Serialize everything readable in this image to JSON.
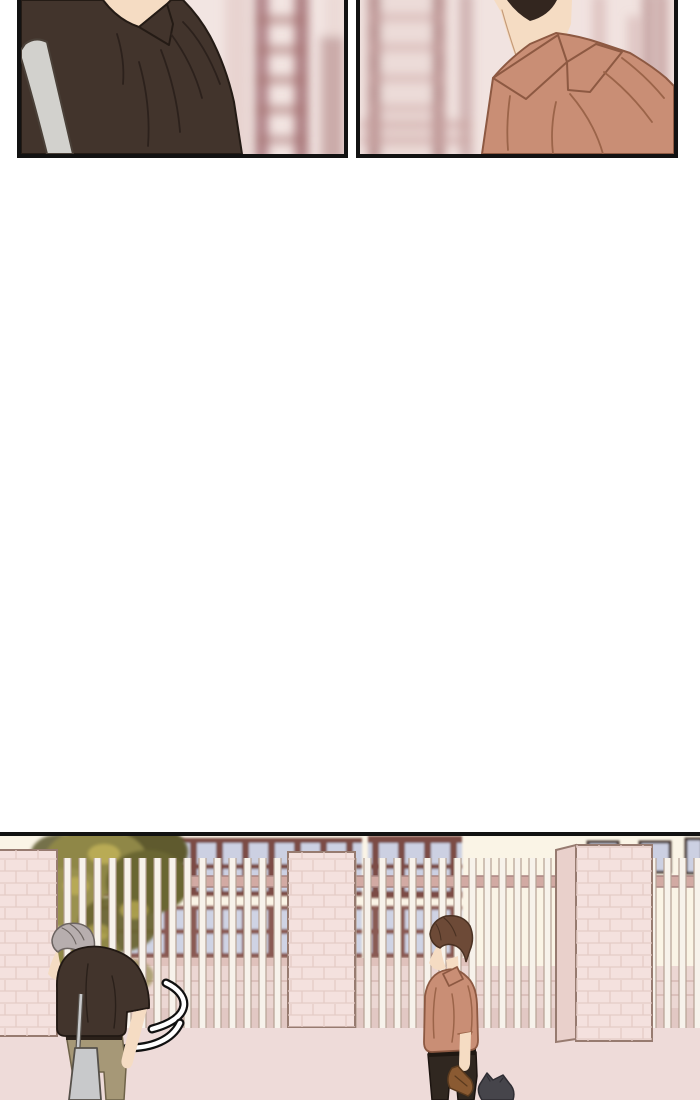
{
  "page": {
    "kind": "webtoon-comic-episode-page",
    "text_content": "none (wordless comic panels)"
  },
  "palette": {
    "page_bg": "#ffffff",
    "panel_border": "#121212",
    "skin": "#f5dcc3",
    "skin_line": "#c59a78",
    "p1_bg": "#f2e5e2",
    "p1_blur_dark": "#9c646a",
    "p1_blur_mid": "#a4706f",
    "p1_blur_light": "#e7d2ce",
    "p1_shirt": "#42342c",
    "p1_shirt_line": "#241b15",
    "p1_fold": "#2c211c",
    "p1_strap": "#d2d1cd",
    "p1_strap_line": "#4a4038",
    "p2_bg": "#f1e3e0",
    "p2_blur_dark": "#a26f70",
    "p2_blur_light": "#ead7d4",
    "p2_blur_band": "#c9a2a0",
    "p2_shirt": "#c98e75",
    "p2_shirt_line": "#8d5942",
    "p2_fold": "#9b6449",
    "p2_hair": "#33261f",
    "p3_building": "#faf4e6",
    "p3_ground": "#eedbd9",
    "p3_ground_line": "#c9a9a5",
    "p3_window_frame": "#7b4b45",
    "p3_window_frame2": "#8a5a52",
    "p3_pane": "#ccd0e2",
    "p3_pane2": "#cfd3e4",
    "p3_sq_frame": "#4a3a35",
    "p3_rail": "#d2aaa3",
    "p3_rail_line": "#a98481",
    "p3_sill": "#e0c2bc",
    "p3_wall": "#ecd7d3",
    "p3_wall_line": "#dcc0bb",
    "p3_wall_base": "#e2c8c4",
    "p3_bar": "#f7f2eb",
    "p3_bar_line": "#b5a193",
    "p3_pillar": "#f4e1de",
    "p3_pillar_side": "#e9d0cb",
    "p3_pillar_line": "#977b70",
    "p3_brick_line": "#e4cbc6",
    "leaf1": "#8f8747",
    "leaf2": "#6b6632",
    "leaf3": "#9a9150",
    "leaf_hi": "#c3b457",
    "leaf_dark": "#5e5a2e",
    "g_hair": "#b7aeae",
    "g_hair_line": "#6d6562",
    "g_shirt": "#42342c",
    "g_shirt_line": "#211813",
    "g_pants": "#a69877",
    "g_pants_line": "#6e6248",
    "g_belt": "#2b211a",
    "g_bag": "#c8c9cb",
    "g_bag_line": "#55504a",
    "b_hair": "#6d4a37",
    "b_hair_line": "#4a3122",
    "b_shirt": "#c98e75",
    "b_shirt_line": "#8d5942",
    "b_fold": "#9b6449",
    "b_pants": "#302720",
    "b_pants_line": "#1c1410",
    "b_belt": "#1f1812",
    "b_sandal": "#8a5a32",
    "b_sandal_line": "#5a3a1e",
    "cat": "#46454b",
    "cat_line": "#2e2d33",
    "swoosh_fill": "#ffffff",
    "swoosh_line": "#101010"
  },
  "panels": [
    {
      "id": "panel-1",
      "description": "Close-up from behind of a person in a dark brown collared shirt with a light gray bag strap over the shoulder, blurred pink building background"
    },
    {
      "id": "panel-2",
      "description": "Close-up of a person's neck and shoulder in a salmon collared shirt, dark hair at top, blurred pink building background"
    },
    {
      "id": "panel-3",
      "description": "Outdoor scene: gray-haired boy in dark shirt with tote bag standing head bowed near a swoosh mark, brown-haired boy in salmon shirt holding sandals beside a dark cat, school building and white fence with pink brick pillars behind"
    }
  ]
}
